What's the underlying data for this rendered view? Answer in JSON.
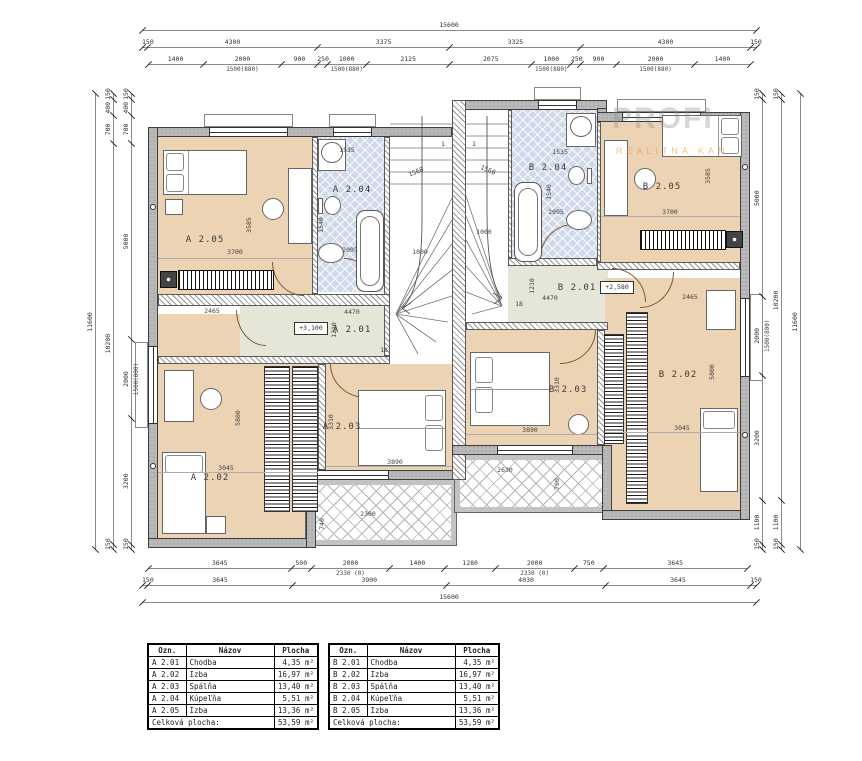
{
  "watermark": {
    "line1": "PROFI",
    "line2": "REALITNA KAN"
  },
  "rooms": {
    "a201": {
      "name": "A 2.01",
      "level": "+3,100",
      "len": "4470",
      "wid": "1210",
      "steps": "18",
      "door": "2465"
    },
    "a202": {
      "name": "A 2.02",
      "w": "3045",
      "h": "5800"
    },
    "a203": {
      "name": "A 2.03",
      "w": "3890",
      "h": "3310"
    },
    "a204": {
      "name": "A 2.04",
      "w": "1535",
      "h": "2095",
      "d": "1540"
    },
    "a205": {
      "name": "A 2.05",
      "w": "3700",
      "h": "3585"
    },
    "b201": {
      "name": "B 2.01",
      "level": "+2,580",
      "len": "4470",
      "wid": "1210",
      "steps": "18",
      "door": "2465"
    },
    "b202": {
      "name": "B 2.02",
      "w": "3045",
      "h": "5800"
    },
    "b203": {
      "name": "B 2.03",
      "w": "3890",
      "h": "3310"
    },
    "b204": {
      "name": "B 2.04",
      "w": "1535",
      "h": "2095",
      "d": "1540"
    },
    "b205": {
      "name": "B 2.05",
      "w": "3700",
      "h": "3585"
    },
    "balc_a": {
      "w": "2300",
      "h": "740"
    },
    "balc_b": {
      "w": "2630",
      "h": "700"
    },
    "stair_a": {
      "r": "1560",
      "w": "1000",
      "start": "1"
    },
    "stair_b": {
      "r": "1560",
      "w": "1000",
      "start": "1"
    }
  },
  "dim_chains": [
    {
      "id": "top-1",
      "o": "h",
      "x": 142,
      "y": 30,
      "len": 614,
      "segs": [
        {
          "t": "15600"
        }
      ]
    },
    {
      "id": "top-2",
      "o": "h",
      "x": 142,
      "y": 47,
      "len": 614,
      "segs": [
        {
          "t": "150"
        },
        {
          "t": "4300"
        },
        {
          "t": "3375"
        },
        {
          "t": "3325"
        },
        {
          "t": "4300"
        },
        {
          "t": "150"
        }
      ]
    },
    {
      "id": "top-3",
      "o": "h",
      "x": 148,
      "y": 64,
      "len": 602,
      "segs": [
        {
          "t": "1400"
        },
        {
          "t": "2000",
          "sub": "1500(880)"
        },
        {
          "t": "900"
        },
        {
          "t": "250"
        },
        {
          "t": "1000",
          "sub": "1500(880)"
        },
        {
          "t": "2125"
        },
        {
          "t": "2075"
        },
        {
          "t": "1000",
          "sub": "1500(880)"
        },
        {
          "t": "250"
        },
        {
          "t": "900"
        },
        {
          "t": "2000",
          "sub": "1500(880)"
        },
        {
          "t": "1400"
        }
      ]
    },
    {
      "id": "bottom-1",
      "o": "h",
      "x": 148,
      "y": 568,
      "len": 599,
      "segs": [
        {
          "t": "3645"
        },
        {
          "t": "500"
        },
        {
          "t": "2000",
          "sub": "2330 (0)"
        },
        {
          "t": "1400"
        },
        {
          "t": "1280"
        },
        {
          "t": "2000",
          "sub": "2330 (0)"
        },
        {
          "t": "750"
        },
        {
          "t": "3645"
        }
      ]
    },
    {
      "id": "bottom-2",
      "o": "h",
      "x": 142,
      "y": 585,
      "len": 614,
      "segs": [
        {
          "t": "150"
        },
        {
          "t": "3645"
        },
        {
          "t": "3900"
        },
        {
          "t": "4030"
        },
        {
          "t": "3645"
        },
        {
          "t": "150"
        }
      ]
    },
    {
      "id": "bottom-3",
      "o": "h",
      "x": 142,
      "y": 602,
      "len": 614,
      "segs": [
        {
          "t": "15600"
        }
      ]
    },
    {
      "id": "left-outer",
      "o": "v",
      "x": 95,
      "y": 550,
      "len": 456,
      "segs": [
        {
          "t": "11600"
        }
      ]
    },
    {
      "id": "left-mid",
      "o": "v",
      "x": 113,
      "y": 550,
      "len": 456,
      "segs": [
        {
          "t": "150"
        },
        {
          "t": "10200"
        },
        {
          "t": "700"
        },
        {
          "t": "400"
        },
        {
          "t": "150"
        }
      ]
    },
    {
      "id": "left-inner",
      "o": "v",
      "x": 131,
      "y": 550,
      "len": 456,
      "segs": [
        {
          "t": "150"
        },
        {
          "t": "3200"
        },
        {
          "t": "2000",
          "sub": "1500(800)"
        },
        {
          "t": "5000"
        },
        {
          "t": "700"
        },
        {
          "t": "400"
        },
        {
          "t": "150"
        }
      ]
    },
    {
      "id": "right-inner",
      "o": "v",
      "x": 762,
      "y": 550,
      "len": 456,
      "segs": [
        {
          "t": "150"
        },
        {
          "t": "1100"
        },
        {
          "t": "3200"
        },
        {
          "t": "2000",
          "sub": "1500(800)"
        },
        {
          "t": "5000"
        },
        {
          "t": "150"
        }
      ]
    },
    {
      "id": "right-mid",
      "o": "v",
      "x": 781,
      "y": 550,
      "len": 456,
      "segs": [
        {
          "t": "150"
        },
        {
          "t": "1100"
        },
        {
          "t": "10200"
        },
        {
          "t": "150"
        }
      ]
    },
    {
      "id": "right-outer",
      "o": "v",
      "x": 800,
      "y": 550,
      "len": 456,
      "segs": [
        {
          "t": "11600"
        }
      ]
    }
  ],
  "tables": {
    "headers": [
      "Ozn.",
      "Názov",
      "Plocha"
    ],
    "a": {
      "rows": [
        [
          "A 2.01",
          "Chodba",
          "4,35 m²"
        ],
        [
          "A 2.02",
          "Izba",
          "16,97 m²"
        ],
        [
          "A 2.03",
          "Spálňa",
          "13,40 m²"
        ],
        [
          "A 2.04",
          "Kúpeľňa",
          "5,51 m²"
        ],
        [
          "A 2.05",
          "Izba",
          "13,36 m²"
        ]
      ],
      "total_label": "Celková plocha:",
      "total_value": "53,59 m²"
    },
    "b": {
      "rows": [
        [
          "B 2.01",
          "Chodba",
          "4,35 m²"
        ],
        [
          "B 2.02",
          "Izba",
          "16,97 m²"
        ],
        [
          "B 2.03",
          "Spálňa",
          "13,40 m²"
        ],
        [
          "B 2.04",
          "Kúpeľňa",
          "5,51 m²"
        ],
        [
          "B 2.05",
          "Izba",
          "13,36 m²"
        ]
      ],
      "total_label": "Celková plocha:",
      "total_value": "53,59 m²"
    }
  }
}
